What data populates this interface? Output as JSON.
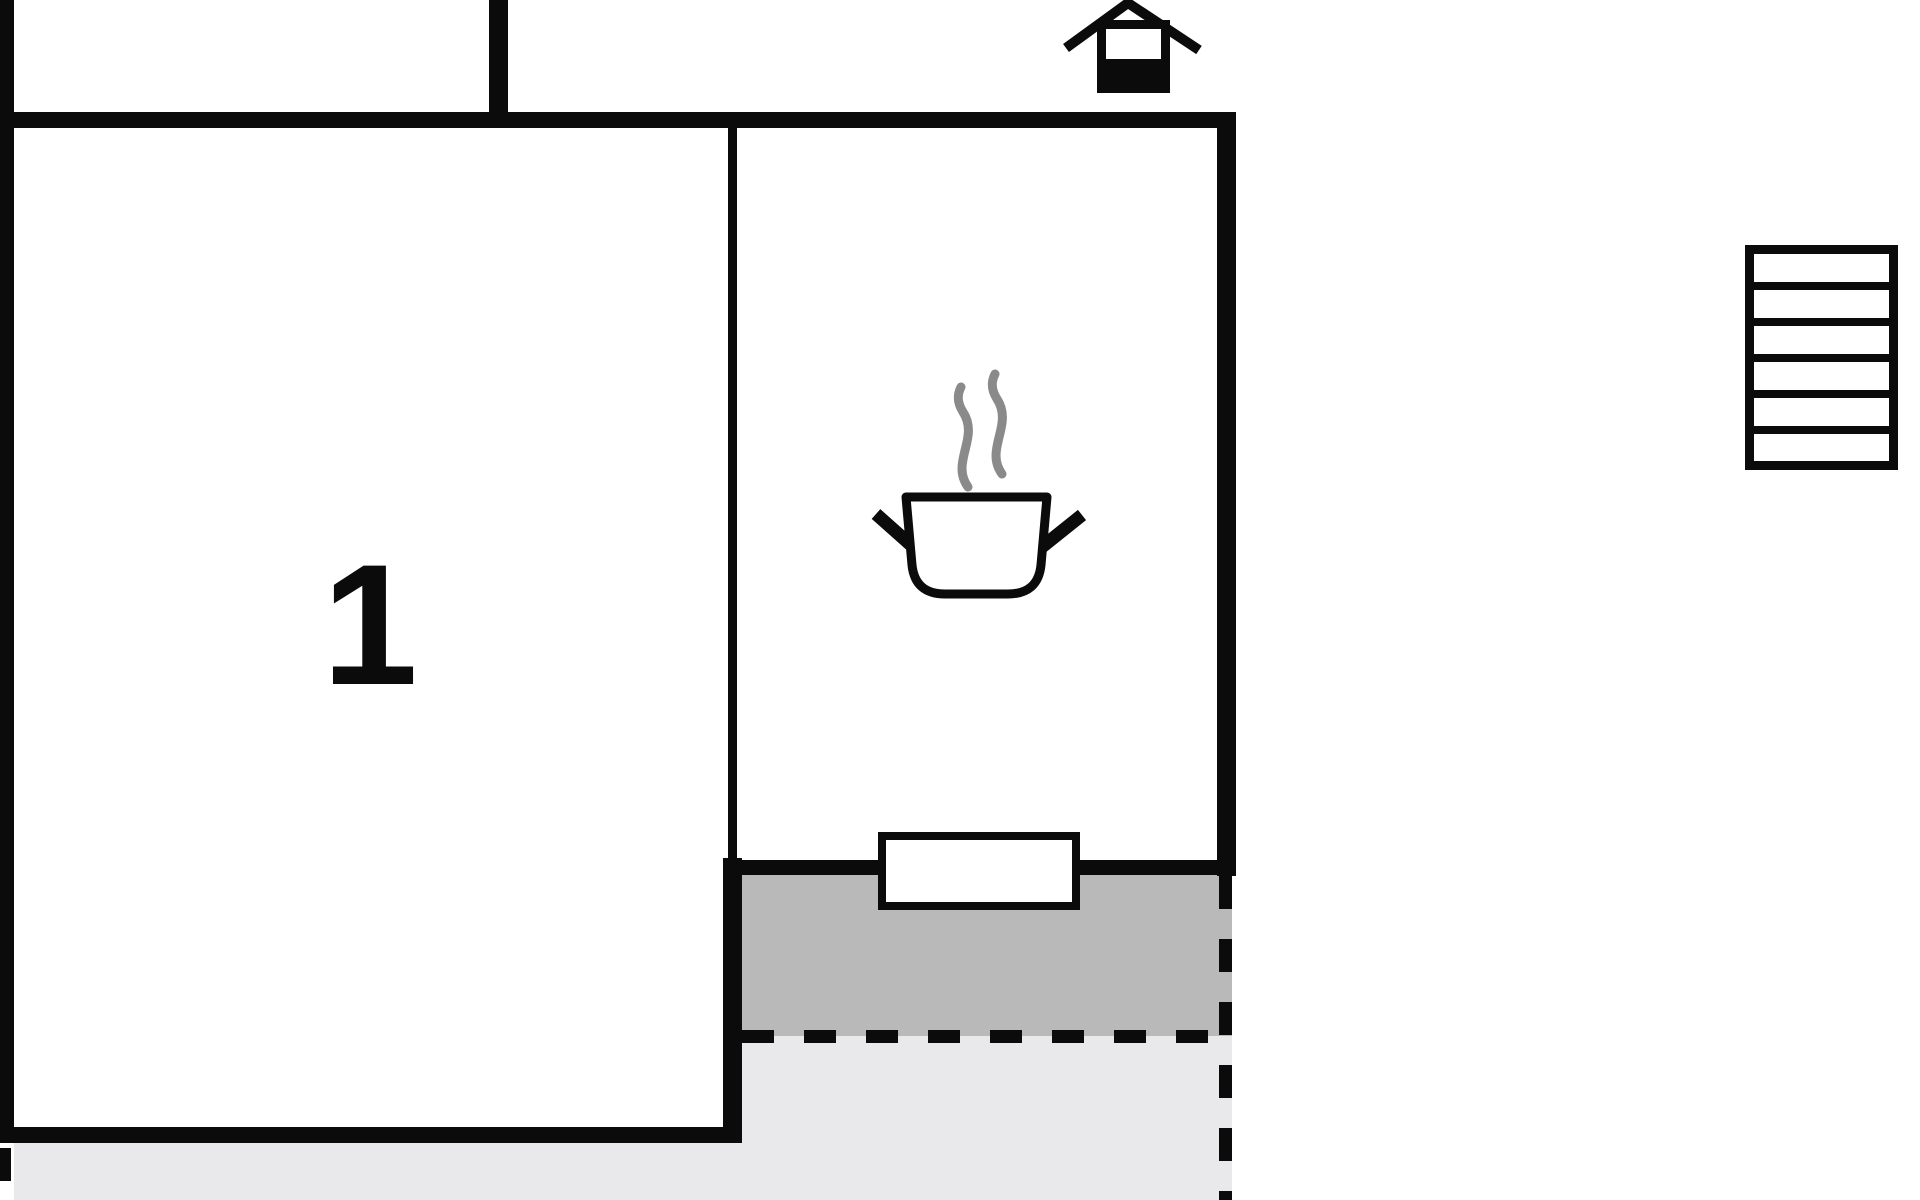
{
  "plan": {
    "room_label": "1",
    "colors": {
      "wall": "#0b0b0b",
      "dark": "#b9b9b9",
      "light": "#e9e9eb",
      "steam": "#8a8a8a"
    },
    "icons": [
      {
        "name": "fireplace-icon",
        "meaning": "chimney / fireplace symbol"
      },
      {
        "name": "cooking-pot-icon",
        "meaning": "kitchen stove symbol"
      },
      {
        "name": "steam-icon",
        "meaning": "steam above pot"
      },
      {
        "name": "stairs-icon",
        "meaning": "staircase"
      },
      {
        "name": "window-marker",
        "meaning": "window opening in wall"
      }
    ],
    "areas": [
      {
        "name": "room-1",
        "label": "1"
      },
      {
        "name": "kitchen"
      },
      {
        "name": "terrace-covered",
        "fill": "dark"
      },
      {
        "name": "terrace-open",
        "fill": "light"
      }
    ]
  }
}
